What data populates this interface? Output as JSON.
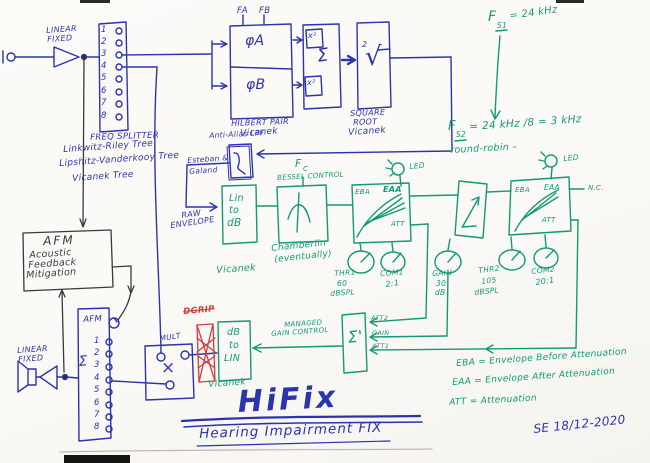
{
  "ink_colors": {
    "blue": "#2b34ae",
    "green": "#149976",
    "black": "#3a3a3a",
    "red": "#d43c3c"
  },
  "input_stage": {
    "label_line1": "LINEAR",
    "label_line2": "FIXED"
  },
  "splitter1": {
    "numbers": [
      "1",
      "2",
      "3",
      "4",
      "5",
      "6",
      "7",
      "8"
    ],
    "caption": "FREQ SPLITTER",
    "tree1": "Linkwitz-Riley Tree",
    "tree2": "Lipshitz-Vanderkooy Tree",
    "tree3": "Vicanek Tree"
  },
  "hilbert": {
    "fa": "FA",
    "fb": "FB",
    "phi_a": "φA",
    "phi_b": "φB",
    "x2_top": "x²",
    "x2_bottom": "x²",
    "sum": "Σ",
    "caption": "HILBERT PAIR",
    "author": "Vicanek"
  },
  "sqrt": {
    "glyph": "√",
    "exp": "2",
    "caption_line1": "SQUARE",
    "caption_line2": "ROOT",
    "author": "Vicanek"
  },
  "anti_alias": {
    "label": "Anti-Alias LPF",
    "author_line1": "Esteban &",
    "author_line2": "Galand"
  },
  "raw_envelope": {
    "line1": "RAW",
    "line2": "ENVELOPE"
  },
  "lin_to_db": {
    "line1": "Lin",
    "line2": "to",
    "line3": "dB",
    "author": "Vicanek"
  },
  "bessel": {
    "fc_main": "F",
    "fc_sub": "C",
    "control": "BESSEL CONTROL",
    "caption_line1": "Chamberlin",
    "caption_line2": "(eventually)"
  },
  "comp1": {
    "eba": "EBA",
    "eaa": "EAA",
    "att": "ATT",
    "led": "LED"
  },
  "comp2": {
    "eba": "EBA",
    "eaa": "EAA",
    "att": "ATT",
    "led": "LED",
    "nc": "N.C."
  },
  "knobs": {
    "thr1": {
      "name": "THR1",
      "value": "60",
      "unit": "dBSPL"
    },
    "com1": {
      "name": "COM1",
      "value": "2:1"
    },
    "gain": {
      "name": "GAIN",
      "value": "30",
      "unit": "dB"
    },
    "thr2": {
      "name": "THR2",
      "value": "105",
      "unit": "dBSPL"
    },
    "com2": {
      "name": "COM2",
      "value": "20:1"
    }
  },
  "sample_rates": {
    "fs1_f": "F",
    "fs1_sub": "S1",
    "fs1_value": "= 24 kHz",
    "fs2_f": "F",
    "fs2_sub": "S2",
    "fs2_value": "= 24 kHz /8 = 3 kHz",
    "note": "round-robin –"
  },
  "sum_block": {
    "glyph": "Σ'",
    "input_top": "ATT2",
    "input_mid": "GAIN",
    "input_bottom": "ATT1"
  },
  "gain_control": {
    "line1": "MANAGED",
    "line2": "GAIN CONTROL"
  },
  "db_to_lin": {
    "line1": "dB",
    "line2": "to",
    "line3": "LIN",
    "author": "Vicanek"
  },
  "dgrip": {
    "label": "DGRIP"
  },
  "mult": {
    "label": "MULT",
    "glyph": "×"
  },
  "splitter2": {
    "label": "AFM",
    "numbers": [
      "1",
      "2",
      "3",
      "4",
      "5",
      "6",
      "7",
      "8"
    ],
    "sum": "Σ"
  },
  "afm": {
    "title": "AFM",
    "line1": "Acoustic",
    "line2": "Feedback",
    "line3": "Mitigation"
  },
  "output_stage": {
    "label_line1": "LINEAR",
    "label_line2": "FIXED"
  },
  "title": {
    "main": "HiFix",
    "subtitle": "Hearing Impairment FIX"
  },
  "legend": {
    "lines": [
      "EBA = Envelope Before Attenuation",
      "EAA = Envelope After Attenuation",
      "ATT = Attenuation"
    ]
  },
  "signature": "SE 18/12-2020"
}
